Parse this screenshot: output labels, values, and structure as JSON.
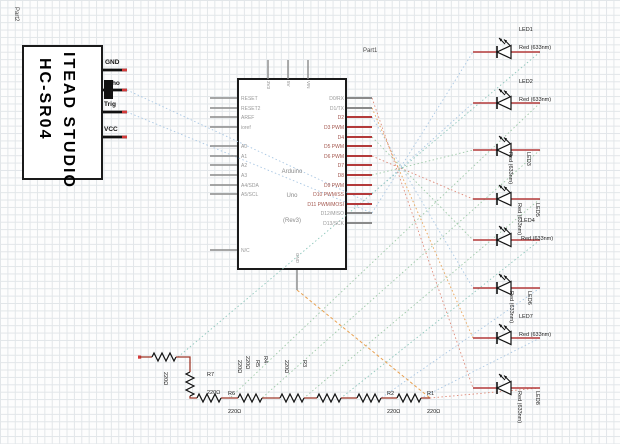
{
  "sensor": {
    "part_label": "Part2",
    "title_line1": "HC-SR04",
    "title_line2": "ITEAD STUDIO",
    "pins": [
      "GND",
      "Echo",
      "Trig",
      "VCC"
    ]
  },
  "arduino": {
    "part_label": "Part1",
    "name_line1": "Arduino",
    "name_line2": "Uno",
    "name_line3": "(Rev3)",
    "left_pins": [
      "RESET",
      "RESET2",
      "AREF",
      "ioref",
      "A0",
      "A1",
      "A2",
      "A3",
      "A4/SDA",
      "A5/SCL",
      "N/C"
    ],
    "right_pins": [
      "D0/RX",
      "D1/TX",
      "D2",
      "D3 PWM",
      "D4",
      "D5 PWM",
      "D6 PWM",
      "D7",
      "D8",
      "D9 PWM",
      "D10 PWM/SS",
      "D11 PWM/MOSI",
      "D12/MISO",
      "D13/SCK"
    ],
    "top_pins": [
      "3V3",
      "5V",
      "VIN"
    ],
    "bottom_pin": "GND"
  },
  "leds": [
    {
      "name": "LED1",
      "type": "Red (633nm)"
    },
    {
      "name": "LED2",
      "type": "Red (633nm)"
    },
    {
      "name": "LED3",
      "type": "Red (633nm)"
    },
    {
      "name": "LED4",
      "type": "Red (633nm)"
    },
    {
      "name": "LED5",
      "type": "Red (633nm)"
    },
    {
      "name": "LED6",
      "type": "Red (633nm)"
    },
    {
      "name": "LED7",
      "type": "Red (633nm)"
    },
    {
      "name": "LED8",
      "type": "Red (633nm)"
    }
  ],
  "resistors": [
    {
      "name": "R7",
      "value": "220Ω"
    },
    {
      "name": "R6",
      "value": "220Ω"
    },
    {
      "name": "R4",
      "value": "220Ω"
    },
    {
      "name": "R5",
      "value": "220Ω"
    },
    {
      "name": "R3",
      "value": "220Ω"
    },
    {
      "name": "R2",
      "value": "220Ω"
    },
    {
      "name": "R1",
      "value": "220Ω"
    },
    {
      "name": "",
      "value": "220Ω"
    }
  ],
  "colors": {
    "wire_red": "#b33a3a",
    "wire_dark": "#a0392b",
    "pin_tip": "#d43a3a",
    "ratsnest_blue": "#a9c7e3",
    "ratsnest_green": "#9ec9a8",
    "ratsnest_teal": "#8fc7bc",
    "ratsnest_red": "#dd8877",
    "ratsnest_orange": "#e8a050"
  }
}
